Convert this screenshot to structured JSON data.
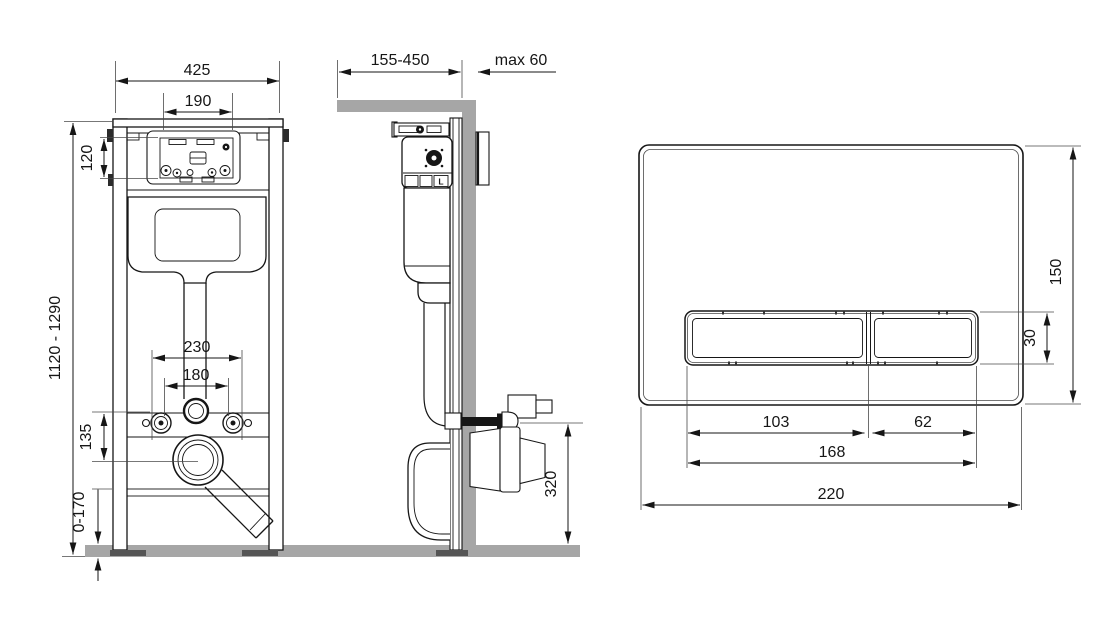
{
  "diagram": {
    "title": "wc-installation-frame-technical-drawing",
    "front_view": {
      "dims": {
        "frame_width": "425",
        "opening_width": "190",
        "opening_height": "120",
        "height_range": "1120 - 1290",
        "fixing_spacing": "230",
        "drain_spacing": "180",
        "outlet_offset": "135",
        "feet_adjustment": "0-170"
      }
    },
    "side_view": {
      "dims": {
        "depth_range": "155-450",
        "wall_thickness_max": "max 60",
        "outlet_height": "320"
      },
      "valve_marking": "L"
    },
    "plate_view": {
      "dims": {
        "height": "150",
        "button_height": "30",
        "large_button_width": "103",
        "small_button_width": "62",
        "buttons_width": "168",
        "width": "220"
      }
    },
    "colors": {
      "line": "#161616",
      "masonry": "#a6a6a6",
      "background": "#ffffff"
    }
  }
}
